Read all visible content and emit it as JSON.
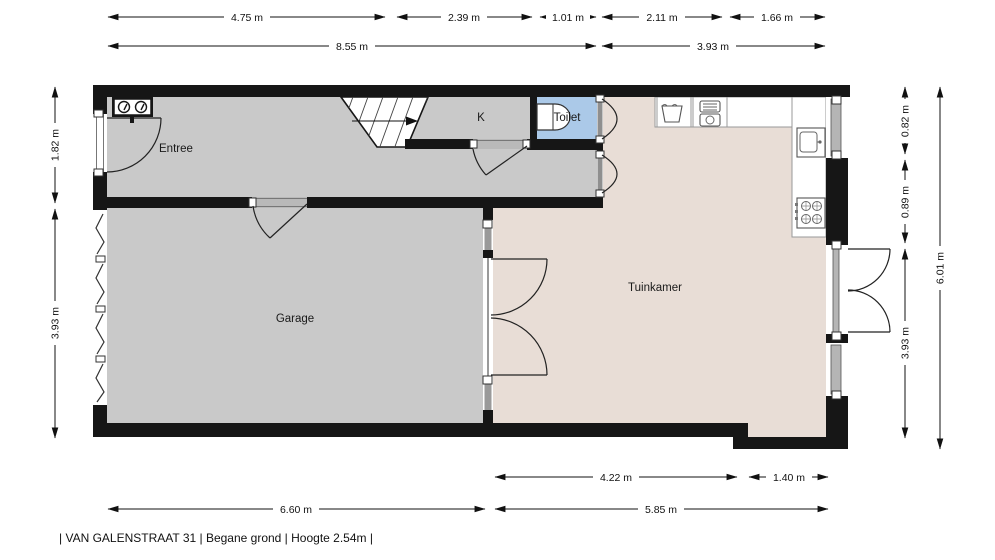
{
  "footer": "| VAN GALENSTRAAT 31 | Begane grond | Hoogte 2.54m |",
  "rooms": {
    "entree": "Entree",
    "kitchen": "K",
    "toilet": "Toilet",
    "garden_room": "Tuinkamer",
    "garage": "Garage"
  },
  "dims": {
    "top1": [
      "4.75 m",
      "2.39 m",
      "1.01 m",
      "2.11 m",
      "1.66 m"
    ],
    "top2": [
      "8.55 m",
      "3.93 m"
    ],
    "left": [
      "1.82 m",
      "3.93 m"
    ],
    "right": [
      "0.82 m",
      "0.89 m",
      "3.93 m"
    ],
    "right_total": "6.01 m",
    "bottom1": [
      "4.22 m",
      "1.40 m"
    ],
    "bottom2": [
      "6.60 m",
      "5.85 m"
    ]
  },
  "colors": {
    "wall": "#161616",
    "room_gray": "#c9c9c9",
    "garden_room_floor": "#e8ddd6",
    "toilet_floor": "#abc9e8",
    "background": "#ffffff"
  }
}
